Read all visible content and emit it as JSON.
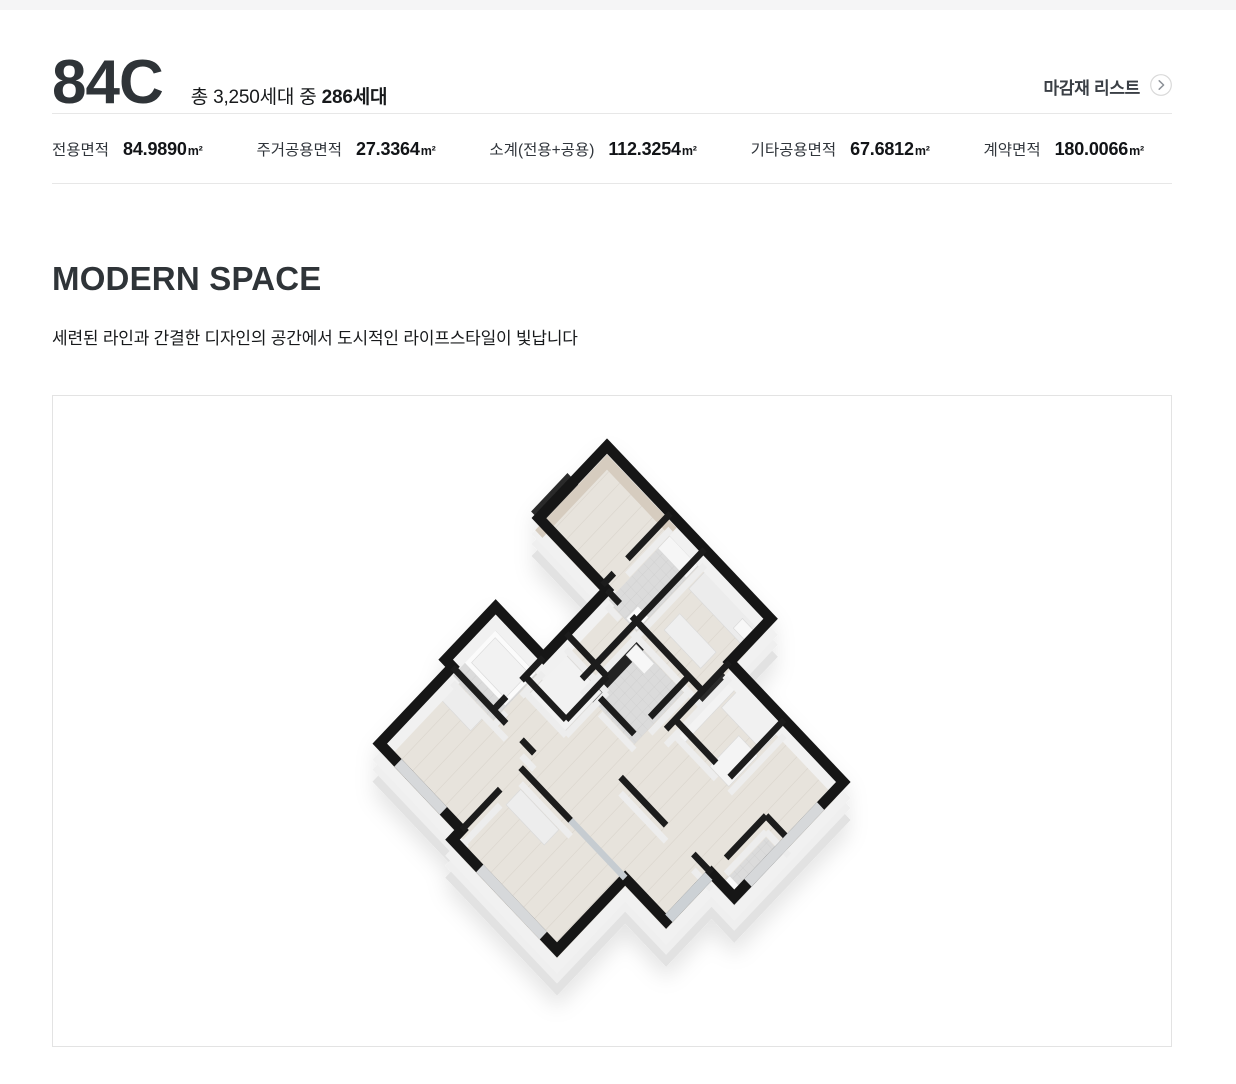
{
  "header": {
    "unit_type": "84C",
    "household_prefix": "총 3,250세대 중 ",
    "household_bold": "286세대",
    "finish_list_label": "마감재 리스트",
    "finish_list_icon": "chevron-right-circle-icon"
  },
  "area_table": {
    "items": [
      {
        "label": "전용면적",
        "value": "84.9890",
        "unit": "m²"
      },
      {
        "label": "주거공용면적",
        "value": "27.3364",
        "unit": "m²"
      },
      {
        "label": "소계(전용+공용)",
        "value": "112.3254",
        "unit": "m²"
      },
      {
        "label": "기타공용면적",
        "value": "67.6812",
        "unit": "m²"
      },
      {
        "label": "계약면적",
        "value": "180.0066",
        "unit": "m²"
      }
    ]
  },
  "section": {
    "title": "MODERN SPACE",
    "subtitle": "세련된 라인과 간결한 디자인의 공간에서 도시적인 라이프스타일이 빛납니다",
    "image_alt": "84C 3D isometric floor plan"
  },
  "colors": {
    "title_dark": "#2f3438",
    "divider": "#e7e7e7",
    "box_border": "#e3e3e3",
    "top_strip": "#f5f5f6",
    "wall_top_black": "#191919",
    "wall_side_white": "#f1f1f1",
    "wall_accent_beige": "#d6ccbf",
    "floor_wood": "#e7e3dc",
    "floor_tile": "#dbdbdb",
    "slab": "#ededed"
  }
}
